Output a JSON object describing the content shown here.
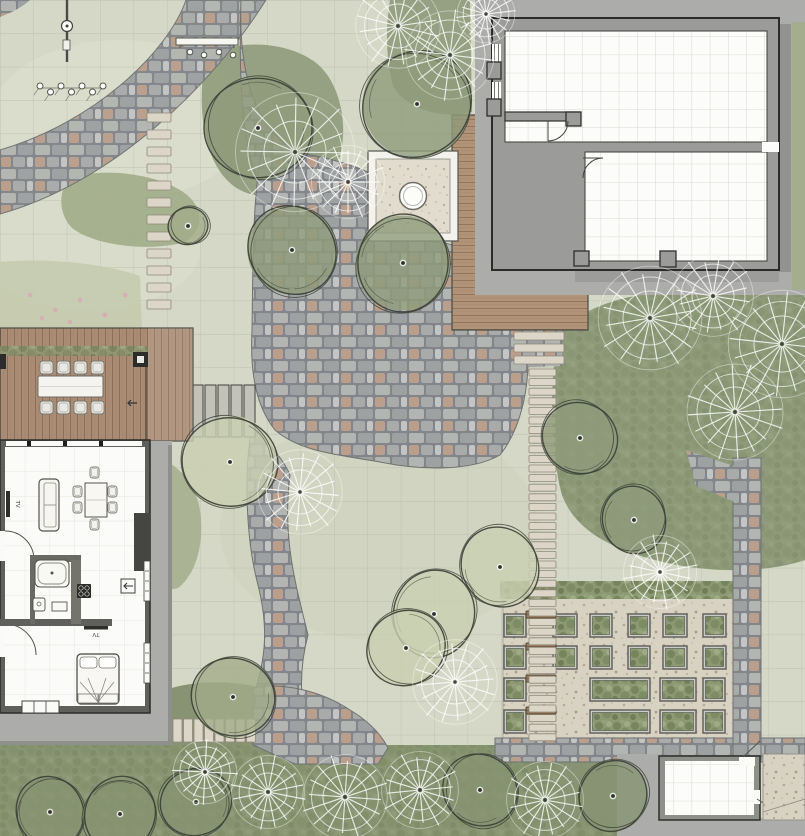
{
  "meta": {
    "title": "landscape-site-plan",
    "width": 805,
    "height": 836
  },
  "labels": {
    "tv": "TV"
  },
  "palette": {
    "lawn": "#d6d8c7",
    "lawnLine": "#b3b7a6",
    "bedLight": "#c6cbb0",
    "bedMid": "#a2ad8a",
    "bedDark": "#8f9b7b",
    "bedDeep": "#879372",
    "cobbleEdge": "#6e7270",
    "stepStone": "#dbd6c8",
    "stepEdge": "#8f897b",
    "slat": "#c2c2bb",
    "slatEdge": "#4e4e47",
    "woodA": "#aa8c75",
    "woodB": "#b09378",
    "woodC": "#a28367",
    "wallGray": "#9b9c99",
    "wallDark": "#2b2b28",
    "houseWall": "#5f5f5b",
    "roomWhite": "#fbfbf9",
    "apron": "#acadaa",
    "apronDark": "#8f908c",
    "gravel": "#d8d2c3",
    "gravelLight": "#e1dccd",
    "bench": "#9a7a5e",
    "benchEdge": "#584533",
    "treeLine": "#3b3e36",
    "white": "#f7f7f4",
    "pink": "#d8a9b4",
    "ink": "#2e2e2b"
  },
  "scene": {
    "trees": [
      {
        "t": "o",
        "x": 258,
        "y": 128,
        "r": 54,
        "f": "dark"
      },
      {
        "t": "o",
        "x": 292,
        "y": 250,
        "r": 46,
        "f": "dark"
      },
      {
        "t": "o",
        "x": 403,
        "y": 263,
        "r": 49,
        "f": "dark"
      },
      {
        "t": "o",
        "x": 417,
        "y": 104,
        "r": 56,
        "f": "dark"
      },
      {
        "t": "o",
        "x": 230,
        "y": 462,
        "r": 48,
        "f": "light"
      },
      {
        "t": "o",
        "x": 500,
        "y": 567,
        "r": 41,
        "f": "light"
      },
      {
        "t": "o",
        "x": 434,
        "y": 614,
        "r": 44,
        "f": "light"
      },
      {
        "t": "o",
        "x": 406,
        "y": 648,
        "r": 40,
        "f": "light"
      },
      {
        "t": "o",
        "x": 233,
        "y": 697,
        "r": 42,
        "f": "mid"
      },
      {
        "t": "o",
        "x": 50,
        "y": 812,
        "r": 36,
        "f": "deep"
      },
      {
        "t": "o",
        "x": 120,
        "y": 814,
        "r": 38,
        "f": "deep"
      },
      {
        "t": "o",
        "x": 196,
        "y": 802,
        "r": 36,
        "f": "deep"
      },
      {
        "t": "o",
        "x": 580,
        "y": 438,
        "r": 38,
        "f": "dark"
      },
      {
        "t": "o",
        "x": 634,
        "y": 520,
        "r": 34,
        "f": "dark"
      },
      {
        "t": "o",
        "x": 613,
        "y": 796,
        "r": 36,
        "f": "deep"
      },
      {
        "t": "o",
        "x": 188,
        "y": 226,
        "r": 20,
        "f": "mid"
      },
      {
        "t": "o",
        "x": 480,
        "y": 790,
        "r": 38,
        "f": "deep"
      },
      {
        "t": "r",
        "x": 295,
        "y": 152,
        "r": 62
      },
      {
        "t": "r",
        "x": 398,
        "y": 26,
        "r": 44
      },
      {
        "t": "r",
        "x": 450,
        "y": 55,
        "r": 46
      },
      {
        "t": "r",
        "x": 348,
        "y": 182,
        "r": 38
      },
      {
        "t": "r",
        "x": 650,
        "y": 318,
        "r": 54
      },
      {
        "t": "r",
        "x": 782,
        "y": 344,
        "r": 56
      },
      {
        "t": "r",
        "x": 735,
        "y": 412,
        "r": 50
      },
      {
        "t": "r",
        "x": 660,
        "y": 572,
        "r": 38
      },
      {
        "t": "r",
        "x": 300,
        "y": 492,
        "r": 44
      },
      {
        "t": "r",
        "x": 455,
        "y": 682,
        "r": 44
      },
      {
        "t": "r",
        "x": 268,
        "y": 792,
        "r": 38
      },
      {
        "t": "r",
        "x": 345,
        "y": 797,
        "r": 44
      },
      {
        "t": "r",
        "x": 420,
        "y": 790,
        "r": 40
      },
      {
        "t": "r",
        "x": 545,
        "y": 800,
        "r": 40
      },
      {
        "t": "r",
        "x": 205,
        "y": 772,
        "r": 33
      },
      {
        "t": "r",
        "x": 486,
        "y": 14,
        "r": 30
      },
      {
        "t": "r",
        "x": 713,
        "y": 296,
        "r": 42
      }
    ],
    "stone_runs": [
      {
        "x": 147,
        "y": 113,
        "w": 24,
        "h": 9,
        "pitch": 17,
        "count": 12,
        "axis": "v",
        "kind": "step"
      },
      {
        "x": 514,
        "y": 332,
        "w": 50,
        "h": 8,
        "pitch": 12,
        "count": 3,
        "axis": "v",
        "kind": "step"
      },
      {
        "x": 529,
        "y": 369,
        "w": 27,
        "h": 7,
        "pitch": 9.6,
        "count": 39,
        "axis": "v",
        "kind": "step"
      },
      {
        "x": 173,
        "y": 719,
        "w": 9,
        "h": 23,
        "pitch": 10.5,
        "count": 8,
        "axis": "h",
        "kind": "step"
      },
      {
        "x": 192,
        "y": 385,
        "w": 11,
        "h": 52,
        "pitch": 13,
        "count": 5,
        "axis": "h",
        "kind": "slat"
      }
    ],
    "planter_garden": {
      "gravel": {
        "x": 503,
        "y": 597,
        "w": 238,
        "h": 156
      },
      "hedge": {
        "x": 500,
        "y": 581,
        "w": 242,
        "h": 18
      },
      "rows": [
        {
          "y": 614,
          "h": 23,
          "items": [
            {
              "x": 504,
              "w": 22
            },
            {
              "x": 553,
              "w": 24
            },
            {
              "x": 590,
              "w": 22
            },
            {
              "x": 628,
              "w": 22
            },
            {
              "x": 663,
              "w": 24
            },
            {
              "x": 703,
              "w": 23
            }
          ]
        },
        {
          "y": 646,
          "h": 23,
          "items": [
            {
              "x": 504,
              "w": 22
            },
            {
              "x": 553,
              "w": 24
            },
            {
              "x": 590,
              "w": 22
            },
            {
              "x": 628,
              "w": 22
            },
            {
              "x": 663,
              "w": 24
            },
            {
              "x": 703,
              "w": 23
            }
          ]
        },
        {
          "y": 678,
          "h": 23,
          "items": [
            {
              "x": 504,
              "w": 22
            },
            {
              "x": 590,
              "w": 60
            },
            {
              "x": 660,
              "w": 36
            },
            {
              "x": 703,
              "w": 22
            }
          ]
        },
        {
          "y": 710,
          "h": 23,
          "items": [
            {
              "x": 504,
              "w": 22
            },
            {
              "x": 590,
              "w": 60
            },
            {
              "x": 660,
              "w": 36
            },
            {
              "x": 703,
              "w": 22
            }
          ]
        }
      ],
      "benches": {
        "x": 526,
        "w": 30,
        "h": 7,
        "ys": [
          611,
          643,
          675,
          707
        ]
      }
    },
    "deck_dining": {
      "chair_xs": [
        40,
        57,
        74,
        91
      ],
      "chair_top_y": 361,
      "chair_bottom_y": 401,
      "chair_size": 13
    },
    "house_dining_chairs": [
      [
        73,
        486
      ],
      [
        73,
        502
      ],
      [
        108,
        486
      ],
      [
        108,
        502
      ],
      [
        90,
        467
      ],
      [
        90,
        519
      ]
    ],
    "plant_row": {
      "x0": 40,
      "y": 87,
      "pitch": 10.5,
      "count": 7
    },
    "bench_dots": [
      [
        190,
        52
      ],
      [
        204,
        55
      ],
      [
        219,
        52
      ],
      [
        233,
        55
      ]
    ],
    "flower_dots": [
      [
        30,
        295
      ],
      [
        55,
        310
      ],
      [
        80,
        300
      ],
      [
        105,
        315
      ],
      [
        125,
        295
      ],
      [
        70,
        322
      ],
      [
        42,
        318
      ]
    ]
  }
}
